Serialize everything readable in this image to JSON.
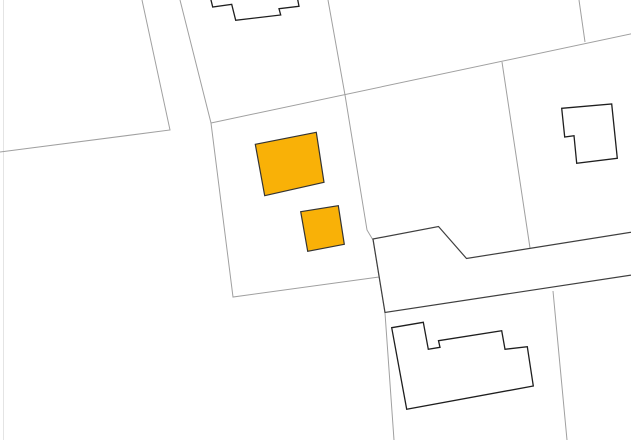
{
  "map": {
    "title": "cadastral-parcel-map",
    "background": "#ffffff",
    "colors": {
      "viewport_edge_line": "#e4e4e4",
      "parcel_line": "#a0a0a0",
      "road_stroke": "#3f3f3f",
      "road_fill": "#ffffff",
      "building_stroke": "#1e1e1e",
      "building_fill": "#ffffff",
      "highlight_fill": "#f9b107",
      "highlight_stroke": "#333333"
    },
    "viewport": {
      "width": 631,
      "height": 440
    },
    "parcel_lines": [
      {
        "name": "viewport-edge-line",
        "points": "3.5,0 3.5,440",
        "color": "#e4e4e4",
        "width": 1
      },
      {
        "name": "parcel-line-northwest",
        "points": "142,0 170,130 0,152",
        "color": "#a0a0a0",
        "width": 1
      },
      {
        "name": "parcel-line-center-left",
        "points": "180,0 211,123 233,297 379,277",
        "color": "#a0a0a0",
        "width": 1
      },
      {
        "name": "parcel-line-long-diagonal",
        "points": "211,123 635,33",
        "color": "#a0a0a0",
        "width": 1
      },
      {
        "name": "parcel-line-center",
        "points": "328,0 345,95 367,230 373,240 385,313 394,440",
        "color": "#a0a0a0",
        "width": 1
      },
      {
        "name": "parcel-line-top-right",
        "points": "579,0 585,42",
        "color": "#a0a0a0",
        "width": 1
      },
      {
        "name": "parcel-line-right-upper",
        "points": "502,62 530,248",
        "color": "#a0a0a0",
        "width": 1
      },
      {
        "name": "parcel-line-right-lower",
        "points": "553,291 567,440",
        "color": "#a0a0a0",
        "width": 1
      }
    ],
    "road": {
      "name": "road-polygon",
      "points": "373,239 438.5,226.5 466.5,258.5 645,230 645,273 385,312.5",
      "fill": "#ffffff",
      "stroke": "#3f3f3f",
      "width": 1.2
    },
    "buildings": [
      {
        "name": "building-top-center",
        "points": "210,-4 212.7,7 231.7,4.3 235.7,20.3 280.7,15 279,8.7 299,6.3 297,-4",
        "fill": "#ffffff",
        "stroke": "#1e1e1e",
        "width": 1.3,
        "highlighted": false
      },
      {
        "name": "building-top-right",
        "points": "561.7,108.3 611.7,104 617.3,158.3 576.7,163.3 574,135.7 564.7,137",
        "fill": "#ffffff",
        "stroke": "#1e1e1e",
        "width": 1.3,
        "highlighted": false
      },
      {
        "name": "building-bottom-center",
        "points": "391.7,327.7 423.3,322.3 428.3,349.3 440,347.3 438.5,340.7 501.7,330.7 505,349.3 527.3,346.7 533.3,386 406.7,409.3",
        "fill": "#ffffff",
        "stroke": "#1e1e1e",
        "width": 1.3,
        "highlighted": false
      },
      {
        "name": "highlighted-building-large",
        "points": "255.3,144.3 316.3,132.3 324,182.3 264.7,195.7",
        "fill": "#f9b107",
        "stroke": "#333333",
        "width": 1.2,
        "highlighted": true
      },
      {
        "name": "highlighted-building-small",
        "points": "300.7,211.7 338.3,205.7 344.3,244.3 307.7,251.3",
        "fill": "#f9b107",
        "stroke": "#333333",
        "width": 1.2,
        "highlighted": true
      }
    ]
  }
}
